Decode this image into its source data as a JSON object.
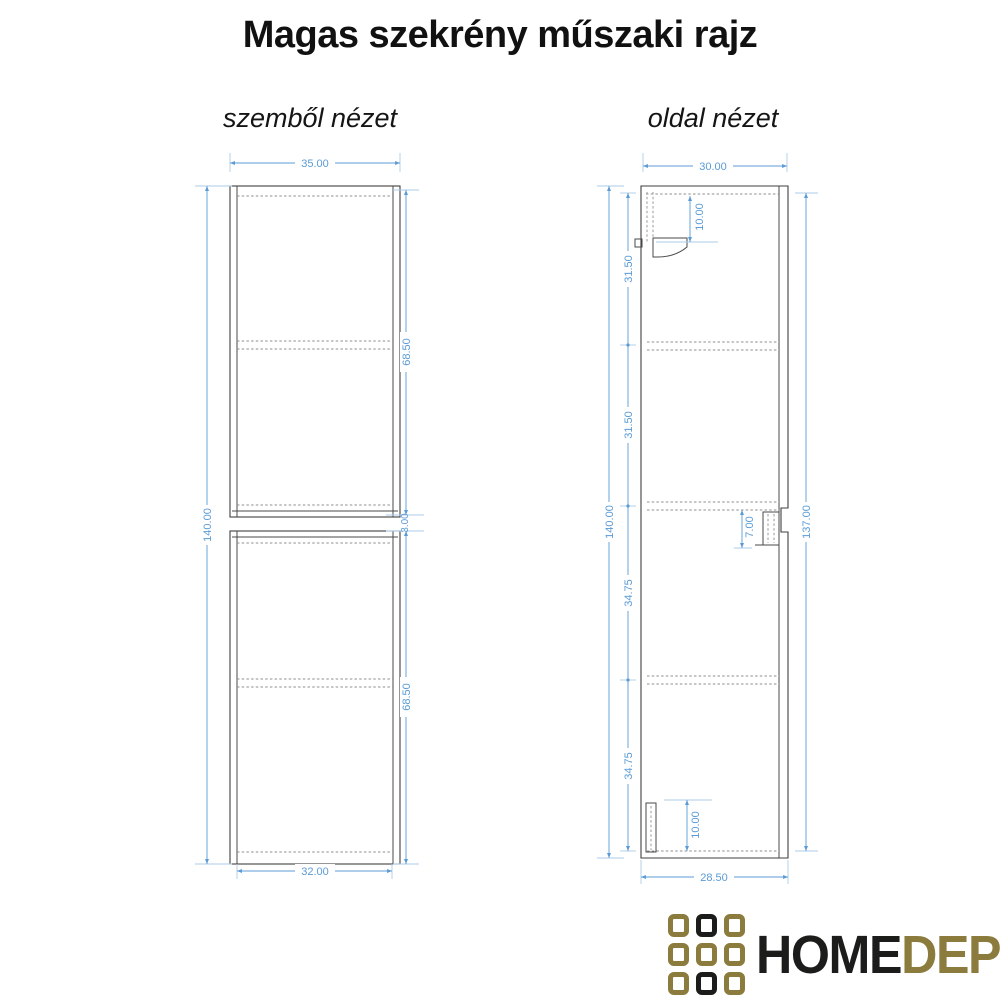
{
  "title": "Magas szekrény műszaki rajz",
  "views": {
    "front": {
      "label": "szemből nézet",
      "dims": {
        "width_top": "35.00",
        "height": "140.00",
        "upper_section": "68.50",
        "gap": "3.00",
        "lower_section": "68.50",
        "width_bottom": "32.00"
      }
    },
    "side": {
      "label": "oldal nézet",
      "dims": {
        "width_top": "30.00",
        "height": "140.00",
        "seg1": "31.50",
        "seg2": "31.50",
        "seg3": "34.75",
        "seg4": "34.75",
        "bracket_top": "10.00",
        "handle_depth": "7.00",
        "bracket_bottom": "10.00",
        "front_height": "137.00",
        "width_bottom": "28.50"
      }
    }
  },
  "logo": {
    "text_primary": "HOME",
    "text_secondary": "DEPO"
  },
  "colors": {
    "dimension_text": "#5b9bd5",
    "dimension_line": "#aecbe8",
    "drawing_line": "#3f3f3f",
    "hidden_line": "#8f8f8f",
    "logo_gold": "#8b7b3c",
    "logo_black": "#1c1c1a",
    "background": "#ffffff"
  }
}
